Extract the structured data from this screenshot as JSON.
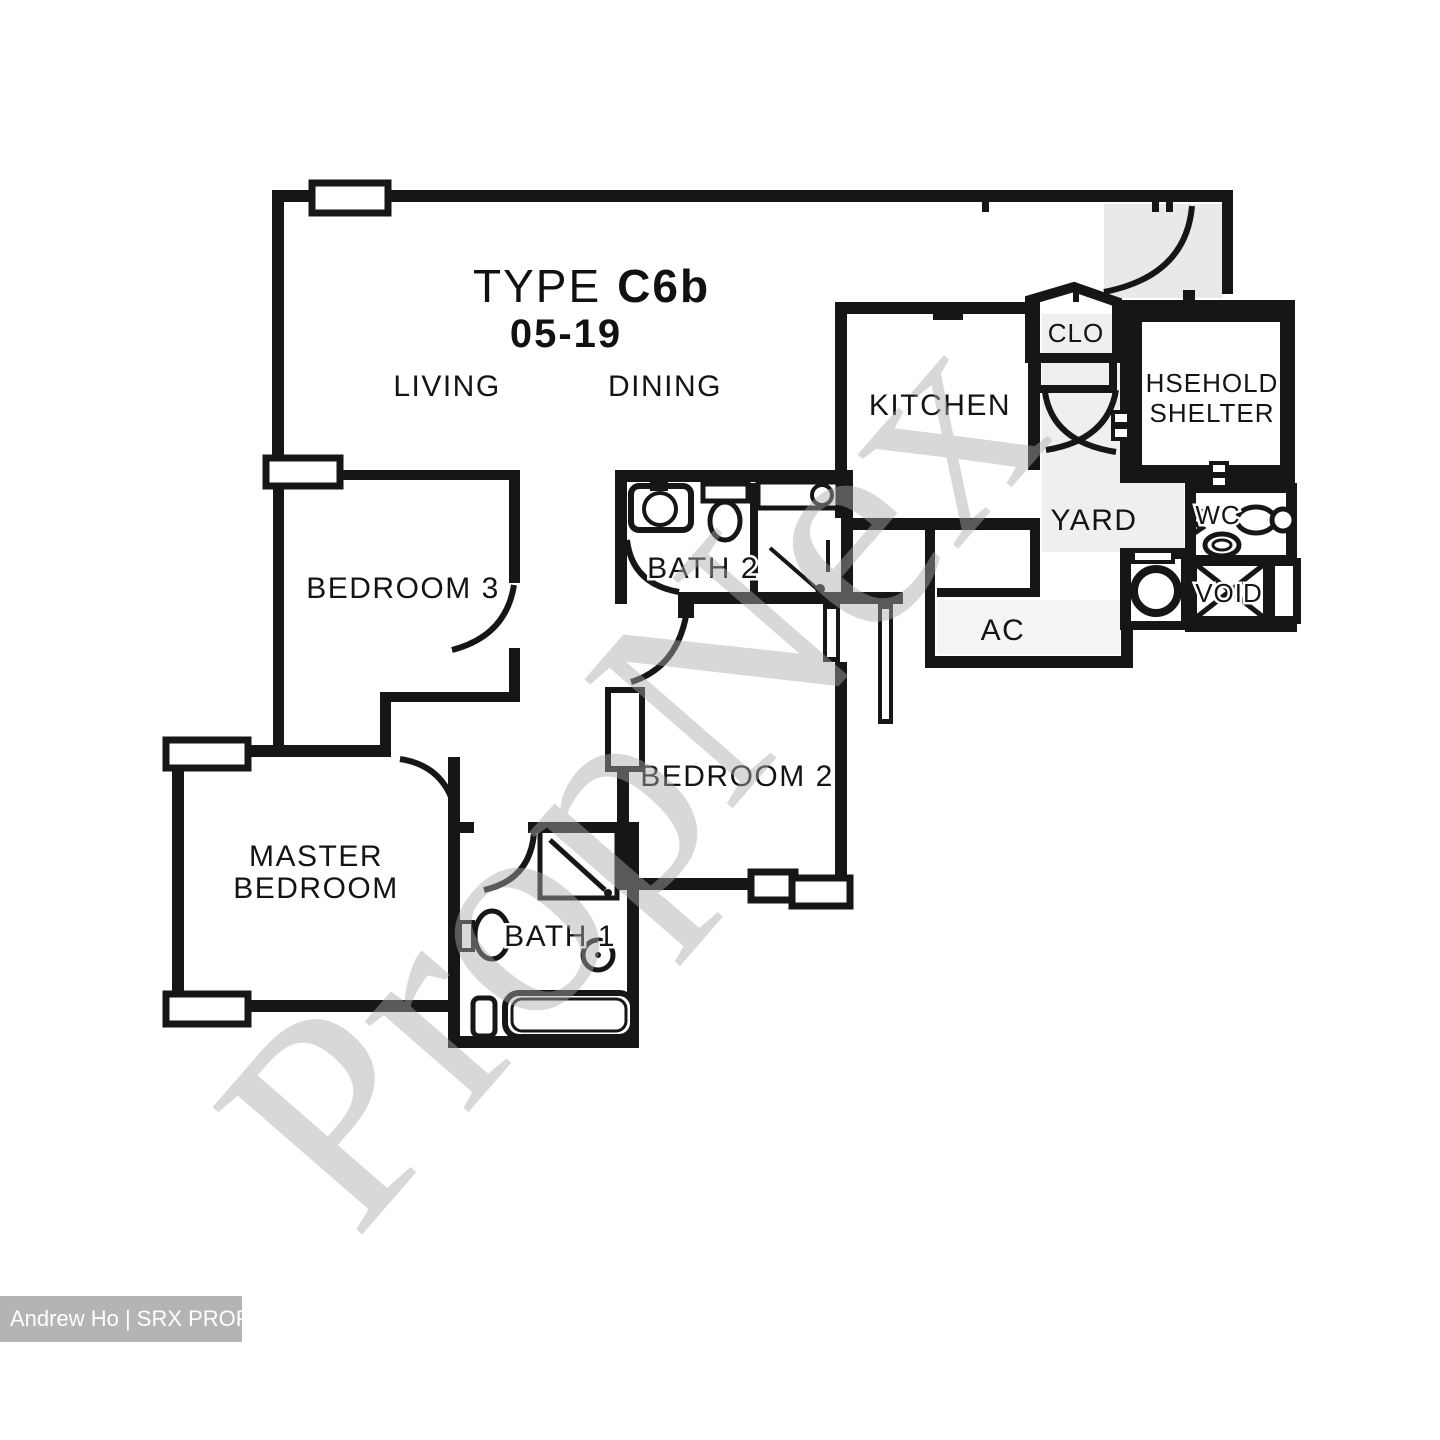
{
  "title": {
    "type": "TYPE",
    "code": "C6b",
    "unit": "05-19"
  },
  "rooms": {
    "living": "LIVING",
    "dining": "DINING",
    "kitchen": "KITCHEN",
    "clo": "CLO",
    "shelter_line1": "HSEHOLD",
    "shelter_line2": "SHELTER",
    "yard": "YARD",
    "wc": "WC",
    "void": "VOID",
    "ac": "AC",
    "bedroom3": "BEDROOM 3",
    "bath2": "BATH 2",
    "bedroom2": "BEDROOM 2",
    "master_line1": "MASTER",
    "master_line2": "BEDROOM",
    "bath1": "BATH 1"
  },
  "watermark": "PropNex",
  "attribution": "Andrew Ho | SRX PROPERTY",
  "colors": {
    "wall": "#161616",
    "watermark": "#ababab",
    "attribution_bg": "#b4b4b4",
    "attribution_text": "#ffffff"
  }
}
